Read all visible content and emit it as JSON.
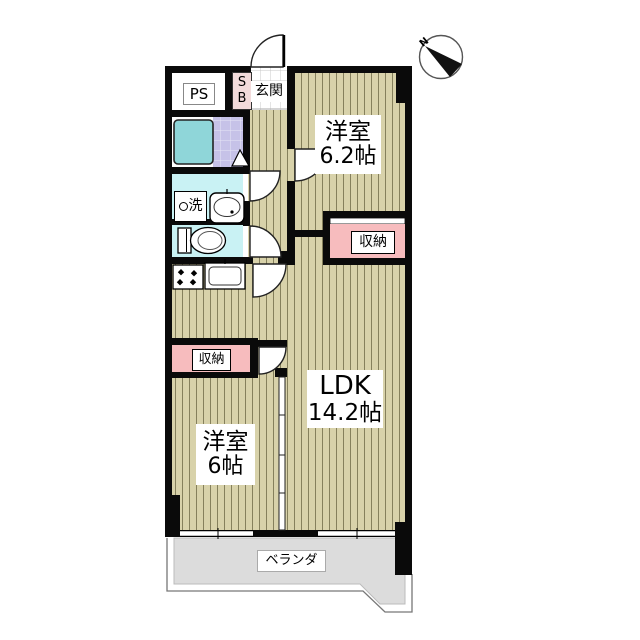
{
  "compass": {
    "n": "N"
  },
  "rooms": {
    "western_room_1": {
      "name": "洋室",
      "size": "6.2帖"
    },
    "ldk": {
      "name": "LDK",
      "size": "14.2帖"
    },
    "western_room_2": {
      "name": "洋室",
      "size": "6帖"
    }
  },
  "labels": {
    "pipe_space": "PS",
    "shoe_box": "S\nB",
    "entrance": "玄関",
    "washer": "洗",
    "storage_right": "収納",
    "storage_left": "収納",
    "veranda": "ベランダ"
  },
  "icons": {
    "compass_north": "circle with black needle wedge pointing from N",
    "door_swing": "white quarter-circle arc",
    "folding_bath_door": "white triangle",
    "bathtub": "teal rounded square",
    "toilet": "tank + bowl ellipse",
    "washbasin": "rounded box with oval basin",
    "stove": "box with four black burner diamonds",
    "kitchen_sink": "box with rounded inner basin",
    "window": "thin white double-line band",
    "partition": "thin double line with panel ticks"
  },
  "colors": {
    "wall": "#0a0a0a",
    "flooring": "#d8d2aa",
    "flooring_stripe": "#85805c",
    "storage_pink": "#f7bcbe",
    "shoebox_pink": "#f2dbdb",
    "wet_room_cyan": "#c9f2f4",
    "bath_tile_purple": "#c6c2e8",
    "bathtub_teal": "#8fd6d9",
    "veranda_gray": "#dcdcdc",
    "entrance_tile": "#ffffff"
  }
}
